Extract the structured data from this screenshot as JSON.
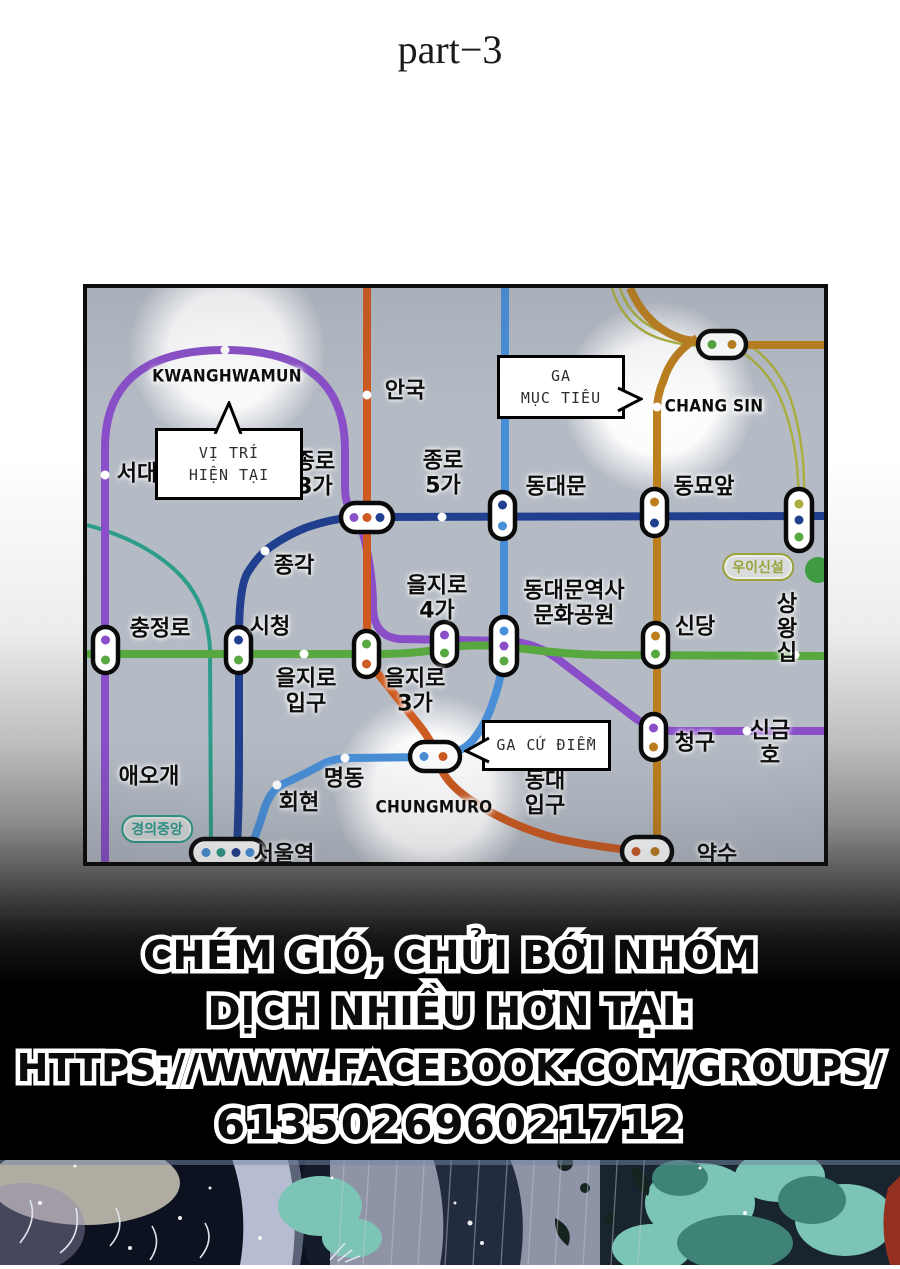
{
  "page": {
    "title": "part−3"
  },
  "map": {
    "colors": {
      "line1": "#20408f",
      "line2": "#57a83f",
      "line3": "#cd5a20",
      "line4": "#498fd8",
      "line5": "#8a4fc8",
      "line6": "#bc7f1e",
      "ui_sinseol": "#a9ae3e",
      "gyeongui": "#2d9c8a",
      "green_circle": "#3f9b42",
      "station_dot": "#ffffff"
    },
    "bubbles": {
      "current": "VỊ TRÍ\nHIỆN TẠI",
      "target": "GA\nMỤC TIÊU",
      "base": "GA CỨ ĐIỂM"
    },
    "highlight_labels": {
      "kwanghwamun": "KWANGHWAMUN",
      "changsin": "CHANG SIN",
      "chungmuro": "CHUNGMURO"
    },
    "stations": {
      "anguk": "안국",
      "seodaemun": "서대",
      "jongno3ga": "종로\n3가",
      "jongno5ga": "종로\n5가",
      "dongdaemun": "동대문",
      "dongmyo": "동묘앞",
      "jonggak": "종각",
      "euljiro4ga": "을지로\n4가",
      "ddm_park": "동대문역사\n문화공원",
      "sindang": "신당",
      "sangwangsimni": "상왕십",
      "chungjeongno": "충정로",
      "cityhall": "시청",
      "euljiroipgu": "을지로\n입구",
      "euljiro3ga": "을지로\n3가",
      "cheonggu": "청구",
      "singeumho": "신금호",
      "aeogae": "애오개",
      "myeongdong": "명동",
      "hoehyeon": "회현",
      "dongdae_ipgu": "동대\n입구",
      "seoul_station": "서울역",
      "yaksu": "약수"
    },
    "badges": {
      "ui_sinseol": "우이신설",
      "gyeongui_jungang": "경의중앙"
    }
  },
  "credit": {
    "line1": "CHÉM GIÓ, CHỬI BỚI NHÓM",
    "line2": "DỊCH NHIỀU HƠN TẠI:",
    "line3": "HTTPS://WWW.FACEBOOK.COM/GROUPS/",
    "line4": "613502696021712"
  }
}
